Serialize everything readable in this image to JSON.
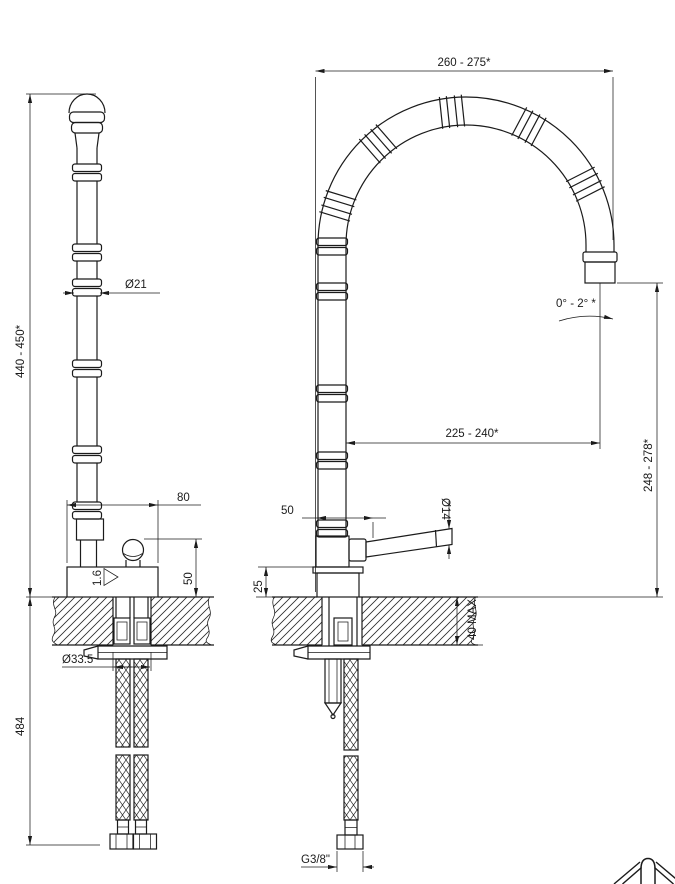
{
  "drawing": {
    "side_view": {
      "overall_height": "440 - 450*",
      "column_diameter": "Ø21",
      "base_width": "80",
      "knob_height": "50",
      "surface_finish": "1.6",
      "hole_diameter": "Ø33.5",
      "hose_length": "484"
    },
    "front_view": {
      "spout_width": "260 - 275*",
      "spout_reach": "225 - 240*",
      "spout_height": "248 - 278*",
      "tilt_angle": "0° - 2° *",
      "lever_offset": "50",
      "lever_diameter": "Ø14",
      "body_height": "25",
      "counter_thickness": "40 MAX",
      "thread_size": "G3/8\""
    }
  }
}
